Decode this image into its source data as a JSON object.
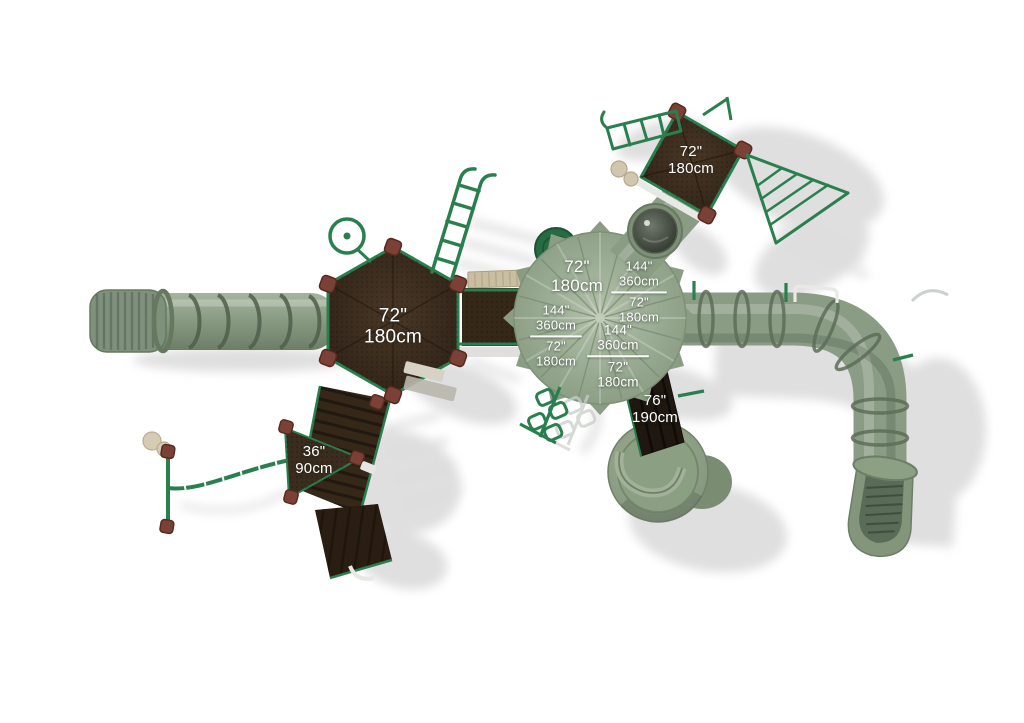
{
  "labels": {
    "hex_deck": {
      "inches": "72\"",
      "cm": "180cm"
    },
    "roof_main": {
      "inches": "72\"",
      "cm": "180cm"
    },
    "roof_pair_right": {
      "top_inches": "144\"",
      "top_cm": "360cm",
      "bottom_inches": "72\"",
      "bottom_cm": "180cm"
    },
    "roof_pair_left": {
      "top_inches": "144\"",
      "top_cm": "360cm",
      "bottom_inches": "72\"",
      "bottom_cm": "180cm"
    },
    "roof_pair_center": {
      "top_inches": "144\"",
      "top_cm": "360cm",
      "bottom_inches": "72\"",
      "bottom_cm": "180cm"
    },
    "square_deck": {
      "inches": "72\"",
      "cm": "180cm"
    },
    "ramp": {
      "inches": "36\"",
      "cm": "90cm"
    },
    "slide_ramp": {
      "inches": "76\"",
      "cm": "190cm"
    }
  },
  "palette": {
    "background": "#ffffff",
    "tube_green": "#8a9c84",
    "roof_green": "#93a68d",
    "rail_green": "#2a7f4e",
    "deck_brown": "#33261a",
    "ramp_dark_brown": "#1f1811",
    "connector_red_brown": "#7b4136",
    "beige_tan": "#c9bda2",
    "label_text": "#ffffff",
    "shadow_gray": "#d6d7d6"
  }
}
